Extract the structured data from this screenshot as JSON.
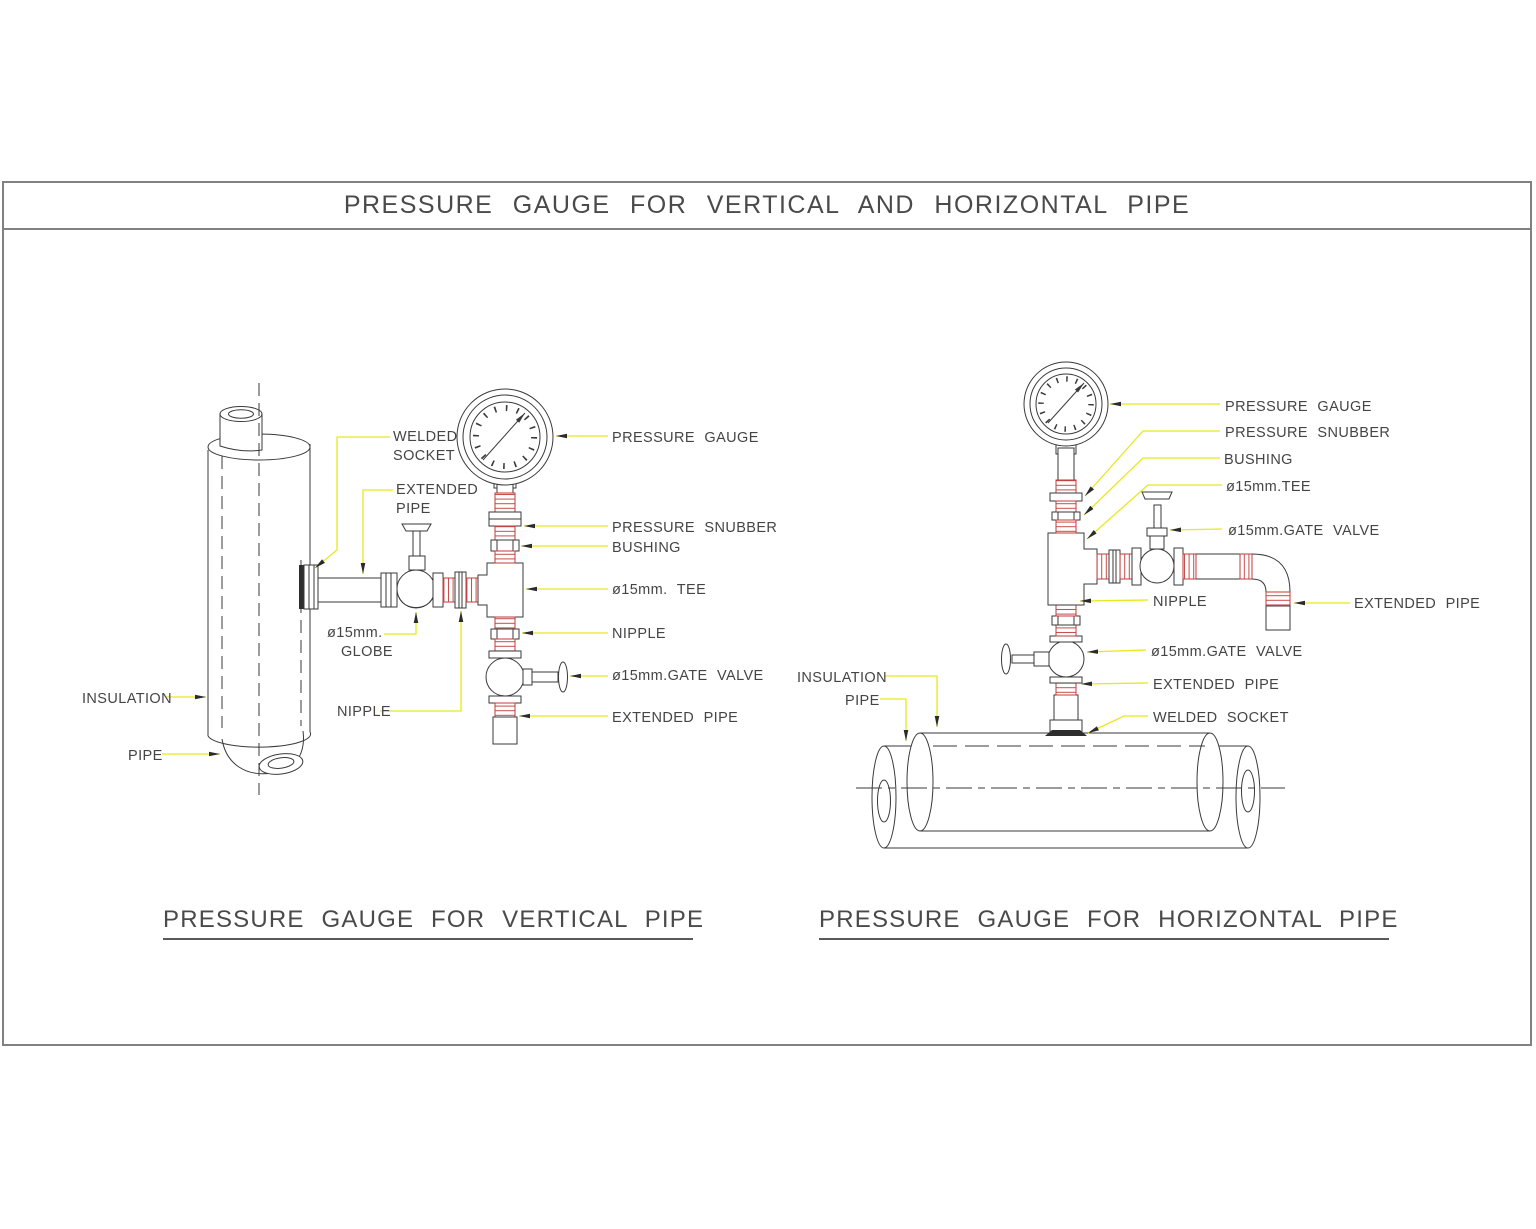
{
  "title_bar": {
    "title": "PRESSURE GAUGE FOR VERTICAL AND HORIZONTAL PIPE"
  },
  "colors": {
    "frame_border": "#818181",
    "drawing_line": "#3a3a3a",
    "leader_yellow": "#e8e81e",
    "thread_red": "#c23b3b",
    "text": "#454545"
  },
  "vertical_pipe_diagram": {
    "caption": "PRESSURE GAUGE FOR VERTICAL PIPE",
    "labels": {
      "welded_socket_line1": "WELDED",
      "welded_socket_line2": "SOCKET",
      "extended_pipe_line1": "EXTENDED",
      "extended_pipe_line2": "PIPE",
      "pressure_gauge": "PRESSURE GAUGE",
      "pressure_snubber": "PRESSURE SNUBBER",
      "bushing": "BUSHING",
      "tee": "ø15mm. TEE",
      "nipple_right": "NIPPLE",
      "gate_valve": "ø15mm.GATE VALVE",
      "extended_pipe_bottom": "EXTENDED PIPE",
      "globe_line1": "ø15mm.",
      "globe_line2": "GLOBE",
      "nipple_left": "NIPPLE",
      "insulation": "INSULATION",
      "pipe": "PIPE"
    }
  },
  "horizontal_pipe_diagram": {
    "caption": "PRESSURE GAUGE FOR HORIZONTAL PIPE",
    "labels": {
      "pressure_gauge": "PRESSURE GAUGE",
      "pressure_snubber": "PRESSURE SNUBBER",
      "bushing": "BUSHING",
      "tee": "ø15mm.TEE",
      "gate_valve_top": "ø15mm.GATE VALVE",
      "nipple": "NIPPLE",
      "extended_pipe_right": "EXTENDED PIPE",
      "gate_valve_bottom": "ø15mm.GATE VALVE",
      "extended_pipe_bottom": "EXTENDED PIPE",
      "welded_socket": "WELDED SOCKET",
      "insulation": "INSULATION",
      "pipe": "PIPE"
    }
  }
}
